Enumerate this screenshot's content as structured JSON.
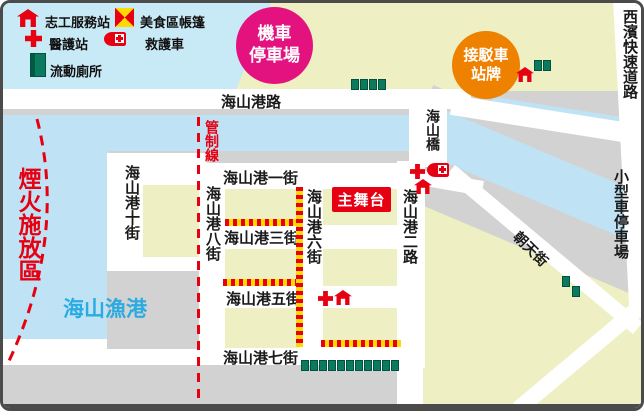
{
  "legend": {
    "items": [
      {
        "icon": "house-icon",
        "label": "志工服務站"
      },
      {
        "icon": "flag-icon",
        "label": "美食區帳篷"
      },
      {
        "icon": "cross-icon",
        "label": "醫護站"
      },
      {
        "icon": "ambulance-icon",
        "label": "救護車"
      },
      {
        "icon": "toilet-icon",
        "label": "流動廁所"
      }
    ]
  },
  "badges": {
    "moto_parking": {
      "line1": "機車",
      "line2": "停車場"
    },
    "shuttle_stop": {
      "line1": "接駁車",
      "line2": "站牌"
    }
  },
  "zones": {
    "fireworks": "煙火施放區",
    "fishing_port": "海山漁港",
    "control_line": "管制線",
    "main_stage": "主舞台",
    "car_parking": "小型車停車場",
    "expressway": "西濱快速道路"
  },
  "roads": {
    "harbor_road": "海山港路",
    "street_1": "海山港一街",
    "street_3": "海山港三街",
    "street_5": "海山港五街",
    "street_7": "海山港七街",
    "street_10": "海山港十街",
    "street_8": "海山港八街",
    "street_6": "海山港六街",
    "road_2": "海山港二路",
    "bridge": "海山橋",
    "chaotian": "朝天街"
  },
  "colors": {
    "water": "#bfe3f4",
    "sky": "#c8eaf6",
    "land": "#eef0c4",
    "quay_gray": "#d2d2d2",
    "road_white": "#ffffff",
    "accent_red": "#e60012",
    "badge_magenta": "#e3127e",
    "badge_orange": "#ee8100",
    "toilet_green": "#0c7a5f",
    "port_text_blue": "#2aabe2"
  },
  "map_features": {
    "toilet_clusters": [
      {
        "x": 348,
        "y": 76,
        "count": 4,
        "dir": "h"
      },
      {
        "x": 531,
        "y": 57,
        "count": 2,
        "dir": "h"
      },
      {
        "x": 559,
        "y": 273,
        "count": 2,
        "dir": "diag"
      },
      {
        "x": 298,
        "y": 357,
        "count": 11,
        "dir": "h"
      }
    ],
    "barriers": [
      {
        "dir": "h",
        "x": 222,
        "y": 216,
        "len": 76
      },
      {
        "dir": "h",
        "x": 220,
        "y": 276,
        "len": 76
      },
      {
        "dir": "h",
        "x": 318,
        "y": 337,
        "len": 80
      },
      {
        "dir": "v",
        "x": 293,
        "y": 184,
        "len": 160
      }
    ],
    "map_icons": [
      {
        "type": "house",
        "x": 513,
        "y": 64
      },
      {
        "type": "cross",
        "x": 407,
        "y": 161
      },
      {
        "type": "ambulance",
        "x": 424,
        "y": 160
      },
      {
        "type": "house",
        "x": 411,
        "y": 176
      },
      {
        "type": "cross",
        "x": 315,
        "y": 288
      },
      {
        "type": "house",
        "x": 331,
        "y": 287
      }
    ]
  }
}
